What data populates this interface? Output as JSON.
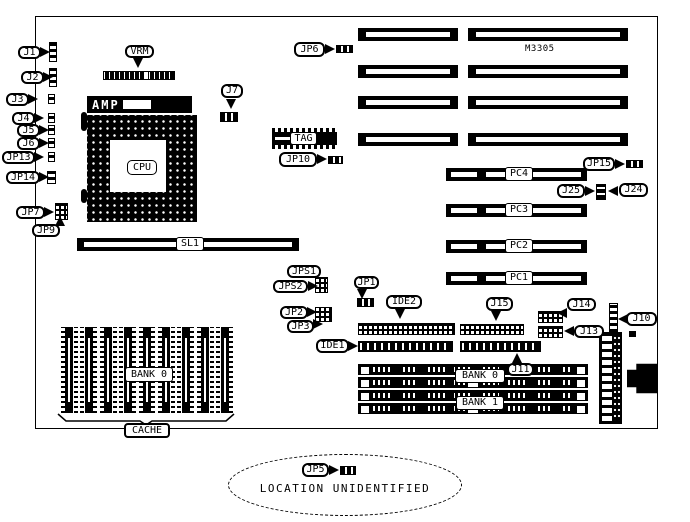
{
  "figure": {
    "kind": "motherboard component location diagram",
    "chipset_text": "M3305",
    "note": {
      "label": "JP5",
      "text": "LOCATION UNIDENTIFIED"
    }
  },
  "labels": {
    "j1": "J1",
    "j2": "J2",
    "j3": "J3",
    "j4": "J4",
    "j5": "J5",
    "j6": "J6",
    "jp13": "JP13",
    "jp14": "JP14",
    "jp7": "JP7",
    "jp9": "JP9",
    "vrm": "VRM",
    "amp": "AMP",
    "cpu": "CPU",
    "sl1": "SL1",
    "j7": "J7",
    "jp6": "JP6",
    "tag": "TAG",
    "jp10": "JP10",
    "jp15": "JP15",
    "j25": "J25",
    "j24": "J24",
    "pc4": "PC4",
    "pc3": "PC3",
    "pc2": "PC2",
    "pc1": "PC1",
    "jps1": "JPS1",
    "jps2": "JPS2",
    "jp1": "JP1",
    "jp2": "JP2",
    "jp3": "JP3",
    "ide2": "IDE2",
    "j15": "J15",
    "j14": "J14",
    "j13": "J13",
    "j10": "J10",
    "ide1": "IDE1",
    "j11": "J11",
    "bank0_simm": "BANK 0",
    "bank1_simm": "BANK 1",
    "bank0_cache": "BANK 0",
    "cache": "CACHE"
  }
}
